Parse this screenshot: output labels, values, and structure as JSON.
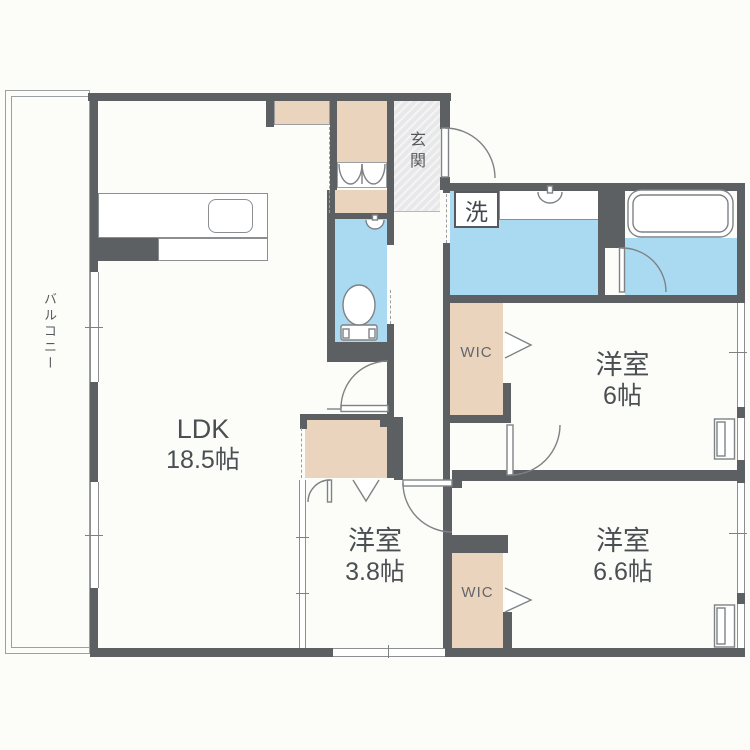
{
  "plan": {
    "rooms": {
      "ldk": {
        "label": "LDK",
        "area": "18.5帖"
      },
      "bedroom_a": {
        "label": "洋室",
        "area": "6帖"
      },
      "bedroom_b": {
        "label": "洋室",
        "area": "6.6帖"
      },
      "bedroom_c": {
        "label": "洋室",
        "area": "3.8帖"
      },
      "balcony": {
        "label": "バルコニー"
      },
      "entrance": {
        "label": "玄関"
      },
      "laundry": {
        "label": "洗"
      },
      "wic_a": {
        "label": "WIC"
      },
      "wic_b": {
        "label": "WIC"
      }
    },
    "colors": {
      "wall": "#5c6063",
      "water_area": "#aadaf2",
      "closet": "#ead4be",
      "entrance_floor": "#e8e8ea",
      "background": "#fcfdf9",
      "text": "#4b4f54",
      "line": "#85898c"
    }
  }
}
